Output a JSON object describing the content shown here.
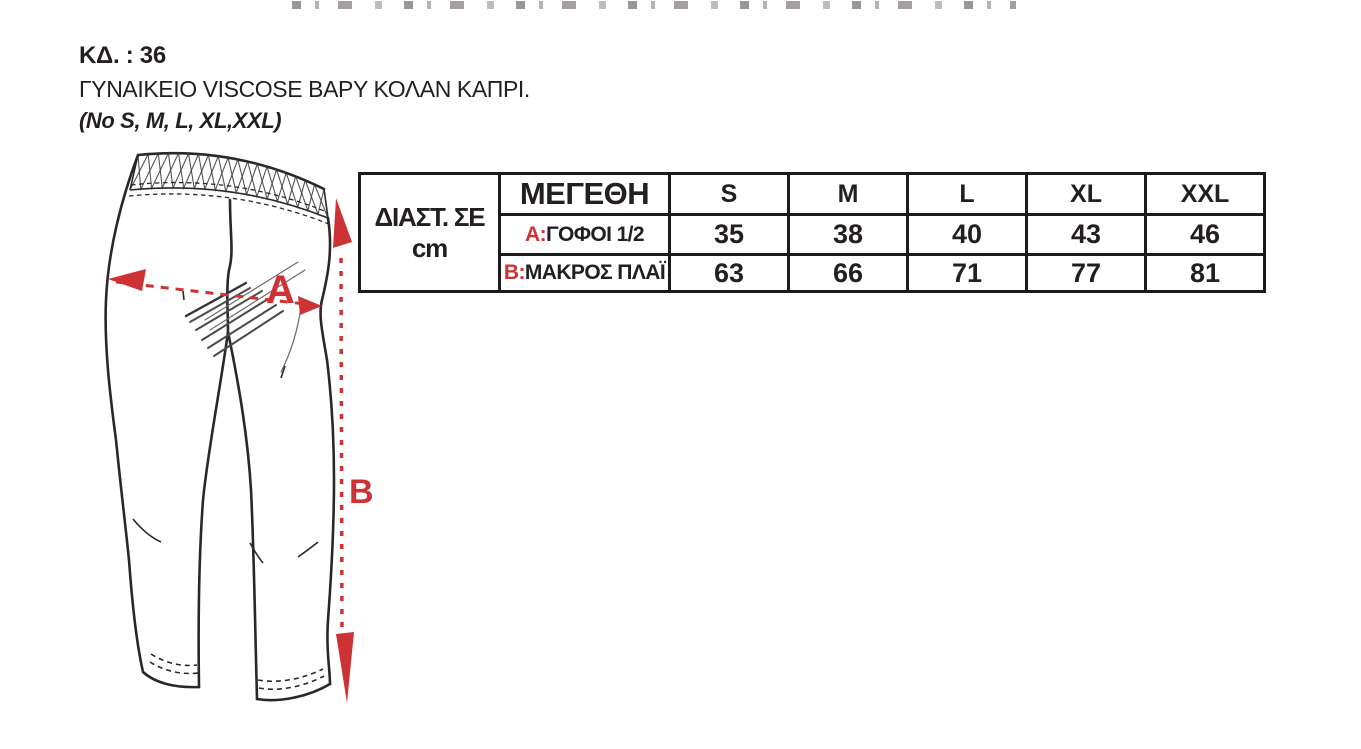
{
  "header": {
    "code": "ΚΔ. : 36",
    "title": "ΓΥΝΑΙΚΕΙΟ VISCOSE ΒΑΡΥ ΚΟΛΑΝ ΚΑΠΡΙ.",
    "size_note": "(No S, M, L, XL,XXL)"
  },
  "diagram": {
    "label_a": "A",
    "label_b": "B",
    "accent_color": "#cd3235",
    "line_color": "#2b2727"
  },
  "size_table": {
    "unit_label": "ΔΙΑΣΤ. ΣΕ cm",
    "header_label": "ΜΕΓΕΘΗ",
    "columns": [
      "S",
      "M",
      "L",
      "XL",
      "XXL"
    ],
    "rows": [
      {
        "key": "A:",
        "label": "ΓΟΦΟΙ 1/2",
        "values": [
          "35",
          "38",
          "40",
          "43",
          "46"
        ]
      },
      {
        "key": "B:",
        "label": "ΜΑΚΡΟΣ ΠΛΑΪ",
        "values": [
          "63",
          "66",
          "71",
          "77",
          "81"
        ]
      }
    ]
  }
}
